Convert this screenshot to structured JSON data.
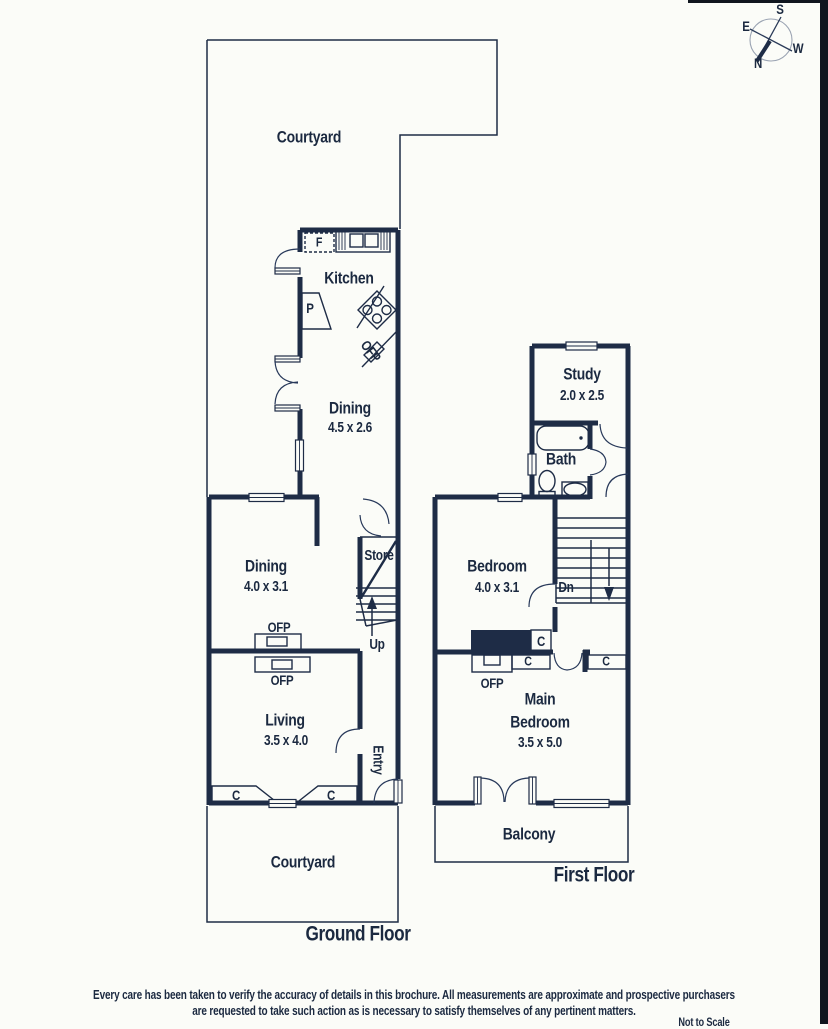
{
  "colors": {
    "ink": "#1e2c46",
    "text": "#1b2940",
    "background": "#fbfcf8",
    "scan_edge": "#10161f",
    "compass_circle": "#9aa3b2"
  },
  "compass": {
    "n": "N",
    "s": "S",
    "e": "E",
    "w": "W"
  },
  "ground": {
    "floor_label": "Ground Floor",
    "courtyard_top": "Courtyard",
    "courtyard_bottom": "Courtyard",
    "kitchen": "Kitchen",
    "fridge": "F",
    "pantry": "P",
    "ofp_kitchen": "OFP",
    "dining1": "Dining",
    "dining1_dims": "4.5 x 2.6",
    "dining2": "Dining",
    "dining2_dims": "4.0 x 3.1",
    "store": "Store",
    "up": "Up",
    "ofp_dining": "OFP",
    "ofp_living": "OFP",
    "living": "Living",
    "living_dims": "3.5 x 4.0",
    "entry": "Entry",
    "c_left": "C",
    "c_right": "C"
  },
  "first": {
    "floor_label": "First Floor",
    "study": "Study",
    "study_dims": "2.0 x 2.5",
    "bath": "Bath",
    "bedroom": "Bedroom",
    "bedroom_dims": "4.0 x 3.1",
    "dn": "Dn",
    "c1": "C",
    "c2": "C",
    "c3": "C",
    "ofp": "OFP",
    "main1": "Main",
    "main2": "Bedroom",
    "main_dims": "3.5 x 5.0",
    "balcony": "Balcony"
  },
  "footer": {
    "line1": "Every care has been taken to verify the accuracy of details in this brochure. All measurements are approximate and prospective purchasers",
    "line2": "are requested to take such action as is necessary to satisfy themselves of any pertinent matters.",
    "scale_note": "Not to Scale"
  }
}
